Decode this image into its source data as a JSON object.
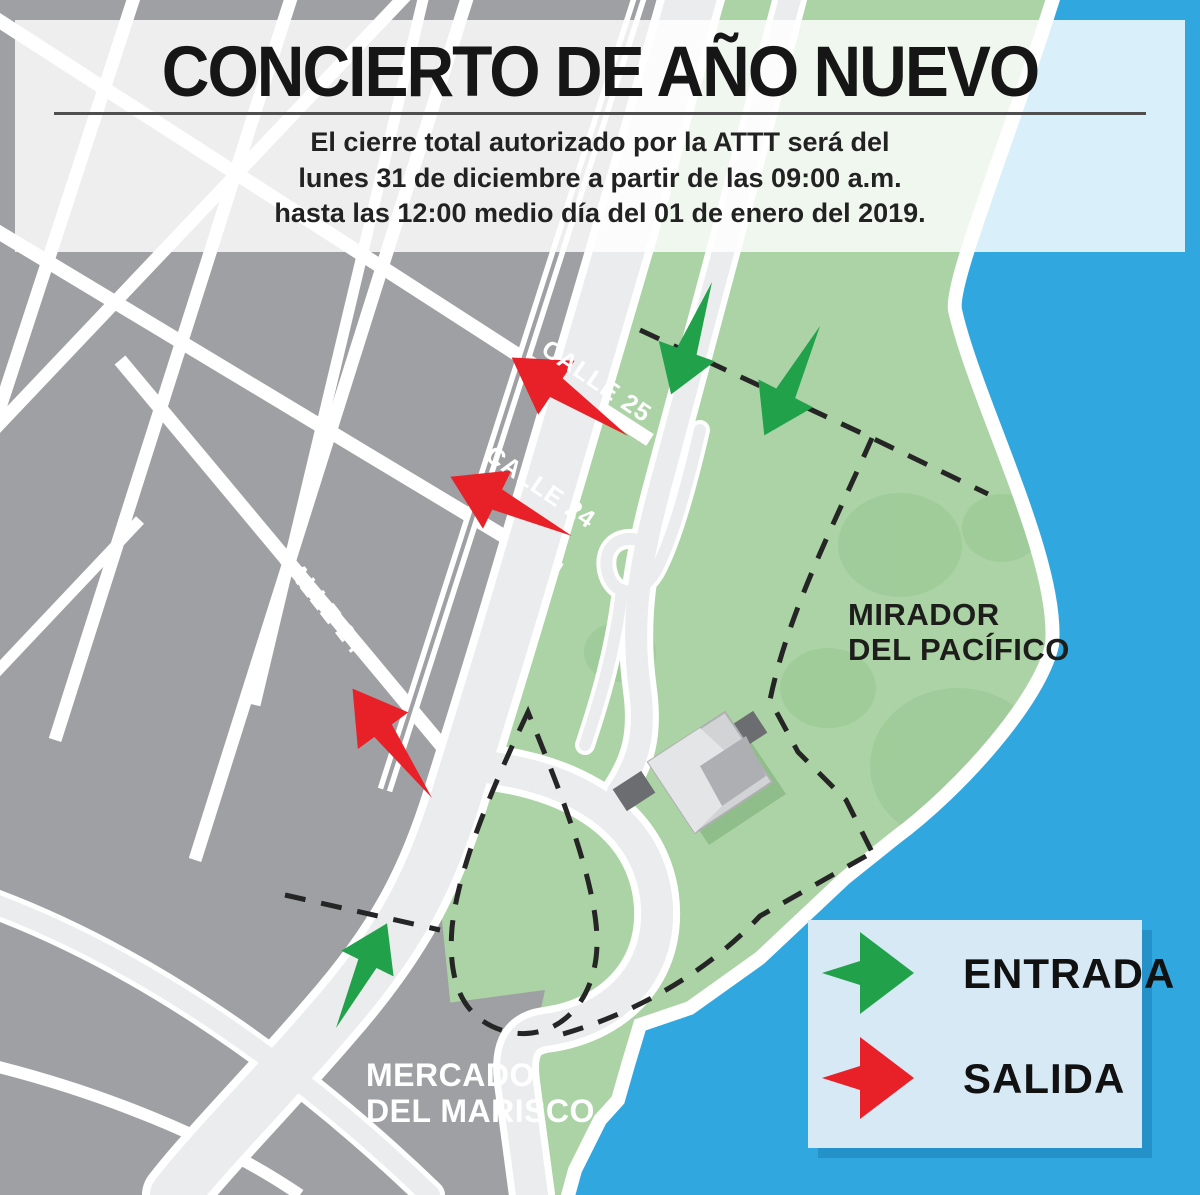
{
  "header": {
    "title": "CONCIERTO DE AÑO NUEVO",
    "subtitle_lines": [
      "El cierre total autorizado por la ATTT será del",
      "lunes 31 de diciembre a partir de las 09:00 a.m.",
      "hasta las 12:00 medio día del 01 de enero del 2019."
    ]
  },
  "map": {
    "street_labels": {
      "calle_25": "CALLE 25",
      "calle_24_upper": "CALLE 24",
      "calle_24_left": "CALLE 24"
    },
    "area_labels": {
      "mirador_line1": "MIRADOR",
      "mirador_line2": "DEL PACÍFICO",
      "mercado_line1": "MERCADO",
      "mercado_line2": "DEL MARISCO"
    }
  },
  "legend": {
    "entrada_label": "ENTRADA",
    "salida_label": "SALIDA"
  },
  "colors": {
    "water": "#31A7E0",
    "legend_shadow": "#2491C8",
    "legend_bg": "#D6E9F5",
    "park": "#ACD3A5",
    "park_blob": "#9CCB97",
    "city_gray": "#9EA0A3",
    "road_fill": "#EBECED",
    "entrada_green": "#22A14B",
    "salida_red": "#E82129",
    "dash_black": "#252525"
  }
}
